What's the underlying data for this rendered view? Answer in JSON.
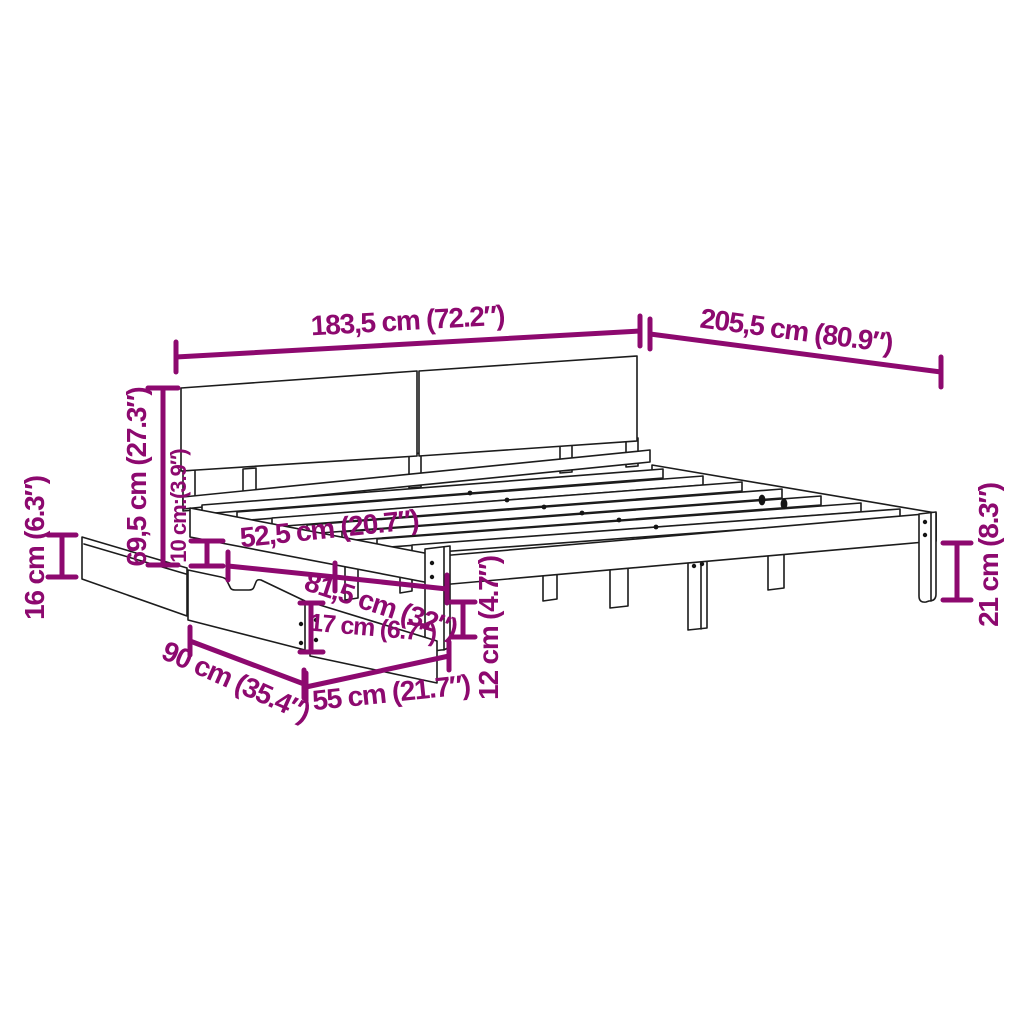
{
  "diagram": {
    "subject": "bed-frame-with-headboard-and-underbed-drawer-dimension-diagram",
    "background": "#ffffff",
    "accent_color": "#8d096f",
    "line_color": "#1c1c1c"
  },
  "dims": {
    "bed_width_top": "183,5 cm (72.2″)",
    "bed_length_top": "205,5 cm (80.9″)",
    "headboard_height": "69,5 cm (27.3″)",
    "side_rail_height": "10 cm:(3.9″)",
    "drawer_side_height": "16 cm (6.3″)",
    "under_rail_span": "52,5 cm (20.7″)",
    "drawer_pullout_span": "81,5 cm (32″)",
    "drawer_front_height": "17 cm (6.7″)",
    "drawer_depth": "90 cm (35.4″)",
    "drawer_width": "55 cm (21.7″)",
    "underbed_clearance": "12 cm (4.7″)",
    "leg_height": "21 cm (8.3″)"
  }
}
